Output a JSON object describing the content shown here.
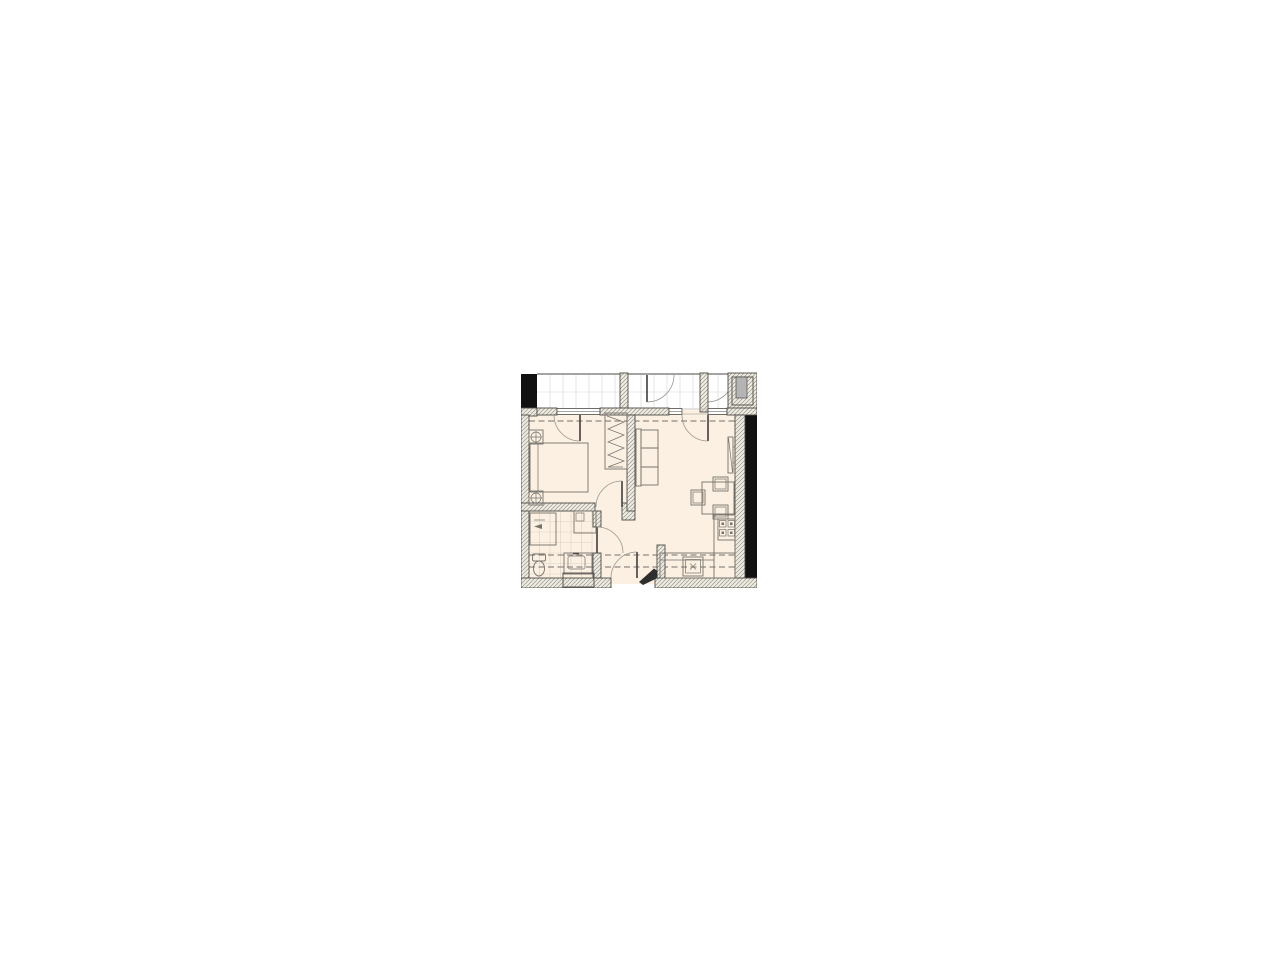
{
  "colors": {
    "floor": "#fbf0e2",
    "wall_fill": "#efede3",
    "wall_hatch_line": "#9a948a",
    "wall_edge": "#4d4a45",
    "black_mass": "#111111",
    "tile_line": "#d3d3d3",
    "bath_tile_line": "#ddd3c3",
    "furniture_line": "#76726c",
    "door_arc": "#9a968f",
    "dashed_line": "#8f8a82",
    "threshold": "#b5b0a8",
    "shaft_gray": "#b4b4b4"
  },
  "floor_plan": {
    "kind": "apartment-floor-plan",
    "rooms": [
      {
        "name": "balcony-corridor",
        "features": [
          "tiled-floor",
          "two-swing-doors",
          "utility-shaft"
        ]
      },
      {
        "name": "bedroom",
        "features": [
          "double-bed",
          "two-nightstands-with-lamps",
          "wardrobe-with-hangers",
          "balcony-door",
          "window"
        ]
      },
      {
        "name": "living-room-kitchen",
        "features": [
          "sofa-three-seat",
          "wall-tv",
          "dining-table",
          "three-chairs",
          "l-shaped-counter",
          "cooktop-four-burner",
          "kitchen-sink",
          "balcony-door",
          "windows"
        ]
      },
      {
        "name": "bathroom",
        "features": [
          "washing-machine",
          "shower-unit",
          "toilet",
          "washbasin",
          "tiled-floor",
          "wall-niche"
        ]
      },
      {
        "name": "hallway",
        "features": [
          "entrance-door",
          "doors-to-bedroom-bathroom"
        ]
      }
    ],
    "wall_symbols": [
      "diagonal-hatch-masonry",
      "solid-black-load-bearing",
      "dashed-beam-lines"
    ]
  }
}
